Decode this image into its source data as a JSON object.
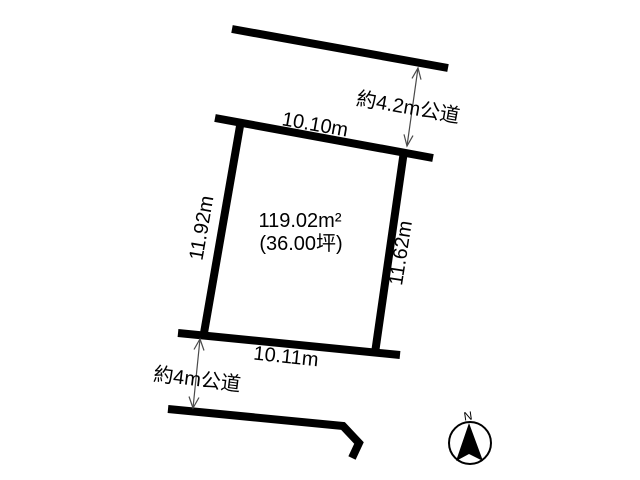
{
  "colors": {
    "line": "#000000",
    "arrow": "#4a4a4a",
    "text": "#000000",
    "background": "#ffffff"
  },
  "plot": {
    "area_m2": "119.02m²",
    "area_tsubo": "(36.00坪)",
    "edges": {
      "top": "10.10m",
      "left": "11.92m",
      "right": "11.62m",
      "bottom": "10.11m"
    }
  },
  "roads": {
    "top": "約4.2m公道",
    "bottom": "約4m公道"
  },
  "compass": {
    "north": "N"
  }
}
